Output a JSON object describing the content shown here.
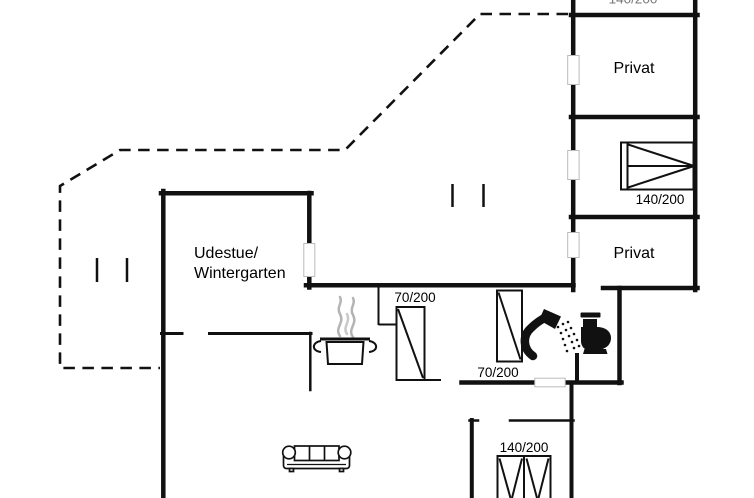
{
  "plan_type": "holiday-house floor plan",
  "labels": {
    "privat_top": "Privat",
    "privat_bottom": "Privat",
    "udestue_line1": "Udestue/",
    "udestue_line2": "Wintergarten",
    "kitchen_door": "70/200",
    "bathroom_door": "70/200",
    "bed_right": "140/200",
    "bed_bottom": "140/200",
    "bed_top_clipped": "140/200"
  },
  "icons": {
    "kitchen": "cooking-pot-icon",
    "kitchen_steam": "steam-icon",
    "bathroom": [
      "shower-icon",
      "toilet-icon"
    ],
    "living_room": "sofa-icon",
    "bedroom_right": "double-bed-icon",
    "bedroom_bottom": "double-bed-icon"
  },
  "colors": {
    "wall_line": "#111111",
    "steam": "#b4b4b4",
    "opening_outline": "#bbbbbb",
    "clipped_text": "#777777",
    "background": "#ffffff"
  }
}
